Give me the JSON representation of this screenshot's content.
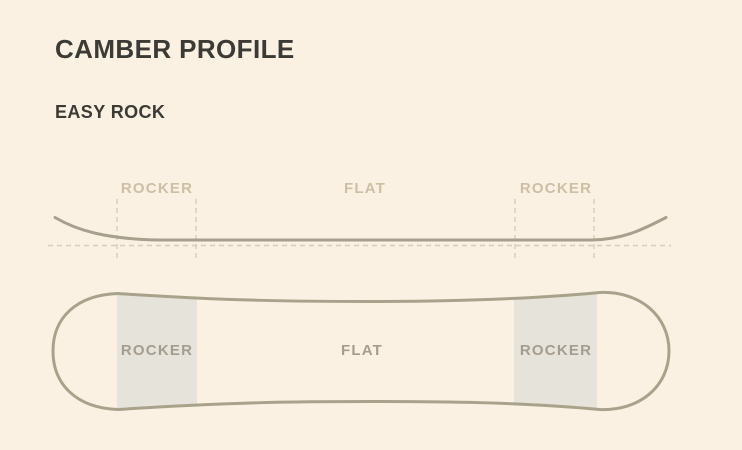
{
  "header": {
    "title": "CAMBER PROFILE",
    "subtitle": "EASY ROCK"
  },
  "side_profile": {
    "zones": [
      {
        "label": "ROCKER"
      },
      {
        "label": "FLAT"
      },
      {
        "label": "ROCKER"
      }
    ]
  },
  "board_top_view": {
    "zones": [
      {
        "label": "ROCKER"
      },
      {
        "label": "FLAT"
      },
      {
        "label": "ROCKER"
      }
    ]
  },
  "colors": {
    "background": "#faf1e3",
    "heading_text": "#3b3a34",
    "profile_line": "#a6a08d",
    "board_outline": "#a9a28b",
    "dashed_guide": "#d5cdbb",
    "side_zone_label": "#ccbfa4",
    "board_zone_label": "#a49d8f",
    "rocker_highlight": "#e6e3db"
  }
}
